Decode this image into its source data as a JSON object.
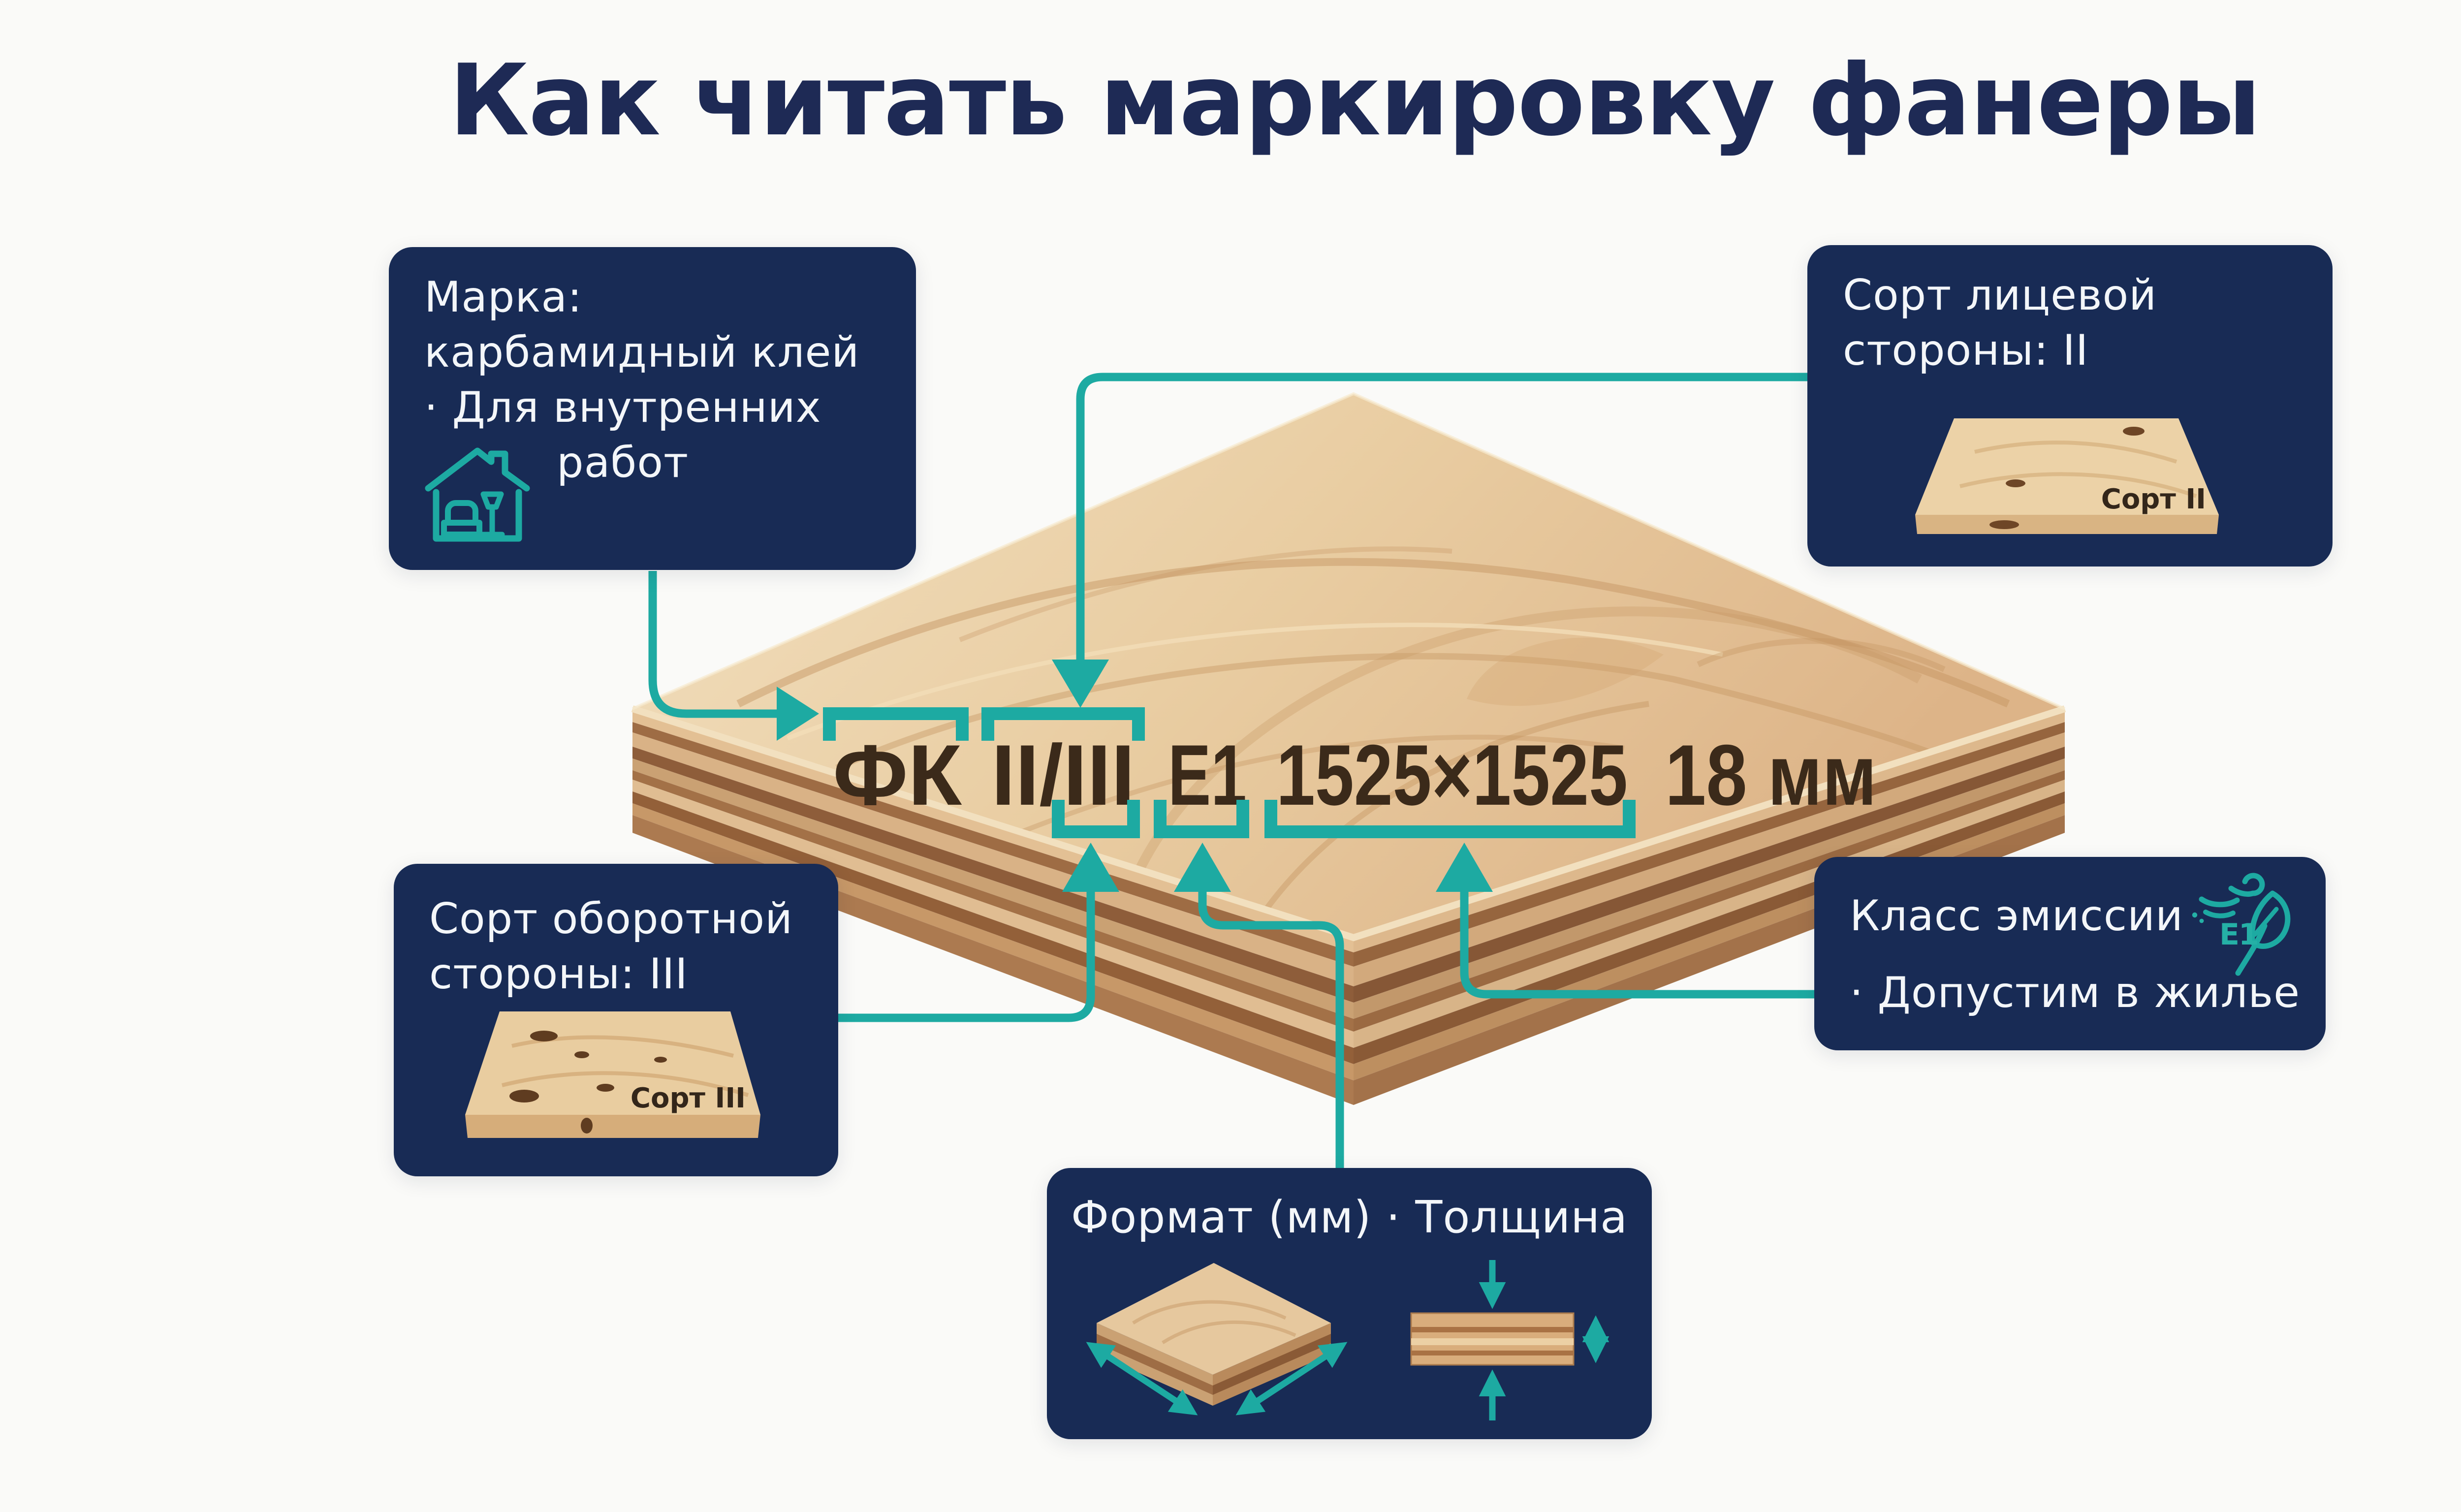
{
  "title": "Как читать маркировку фанеры",
  "marking": {
    "brand": "ФК",
    "grades": "II/III",
    "emission_class": "Е1",
    "format": "1525×1525",
    "thickness": "18 мм"
  },
  "cards": {
    "brand": {
      "line1": "Марка:",
      "line2": "карбамидный клей",
      "line3": "· Для внутренних",
      "line4": "работ",
      "icon": "house-interior-icon"
    },
    "face_grade": {
      "line1": "Сорт лицевой",
      "line2": "стороны: II",
      "board_label": "Сорт II"
    },
    "back_grade": {
      "line1": "Сорт оборотной",
      "line2": "стороны: III",
      "board_label": "Сорт III"
    },
    "emission": {
      "line1": "Класс эмиссии",
      "line2": "· Допустим в жилье",
      "badge": "E1",
      "icon": "e1-leaf-wind-icon"
    },
    "format": {
      "title": "Формат (мм) · Толщина",
      "icon_left": "sheet-format-icon",
      "icon_right": "thickness-icon"
    }
  },
  "colors": {
    "background": "#fafaf8",
    "navy_card": "#182b55",
    "title_navy": "#1e2a55",
    "teal_accent": "#1daaa2",
    "marking_text": "#3b2a1a",
    "card_text": "#f3f6f9",
    "wood_light": "#f0dab8",
    "wood_dark": "#9e6c44"
  }
}
